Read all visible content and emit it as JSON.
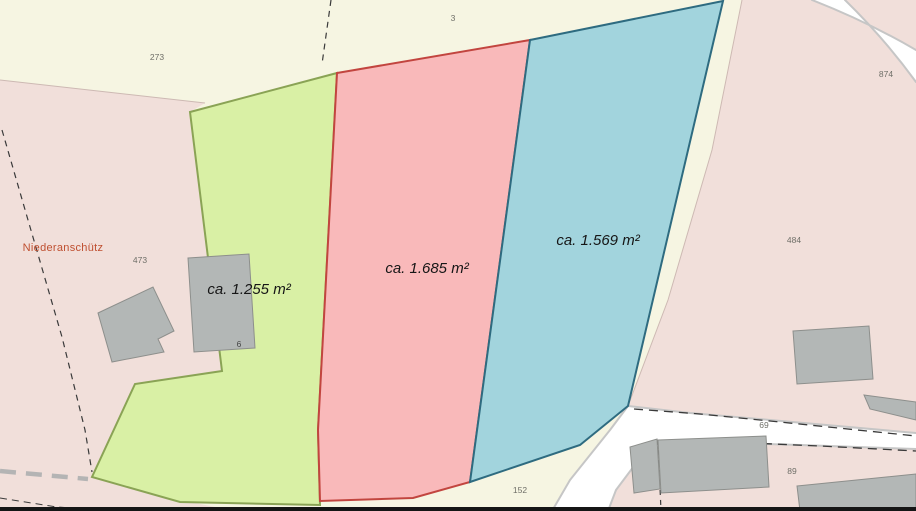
{
  "title": "Cadastral parcel map",
  "map": {
    "place_label": {
      "text": "Niederanschütz",
      "color": "#bf4f30"
    },
    "parcels": [
      {
        "name": "parcel-green",
        "area_label": "ca. 1.255 m²",
        "fill": "#d9f0a5",
        "stroke": "#8aa355"
      },
      {
        "name": "parcel-red",
        "area_label": "ca. 1.685 m²",
        "fill": "#f9b9ba",
        "stroke": "#c2453f"
      },
      {
        "name": "parcel-blue",
        "area_label": "ca. 1.569 m²",
        "fill": "#a2d4dd",
        "stroke": "#2e6b80"
      }
    ],
    "parcel_numbers": [
      {
        "text": "273"
      },
      {
        "text": "3"
      },
      {
        "text": "874"
      },
      {
        "text": "473"
      },
      {
        "text": "484"
      },
      {
        "text": "6"
      },
      {
        "text": "69"
      },
      {
        "text": "89"
      },
      {
        "text": "152"
      }
    ],
    "colors": {
      "background": "#f6f5e2",
      "settlement": "#f1dfda",
      "building": "#b3b7b6",
      "building_outline": "#8d8f8c",
      "road_fill": "#ffffff",
      "road_casing": "#c6c6c6",
      "boundary": "#3a3a3a",
      "boundary_gray": "#b4b4b4",
      "number_label": "#6f6f68",
      "house_number_label": "#454545",
      "bottom_bar": "#151515"
    }
  }
}
